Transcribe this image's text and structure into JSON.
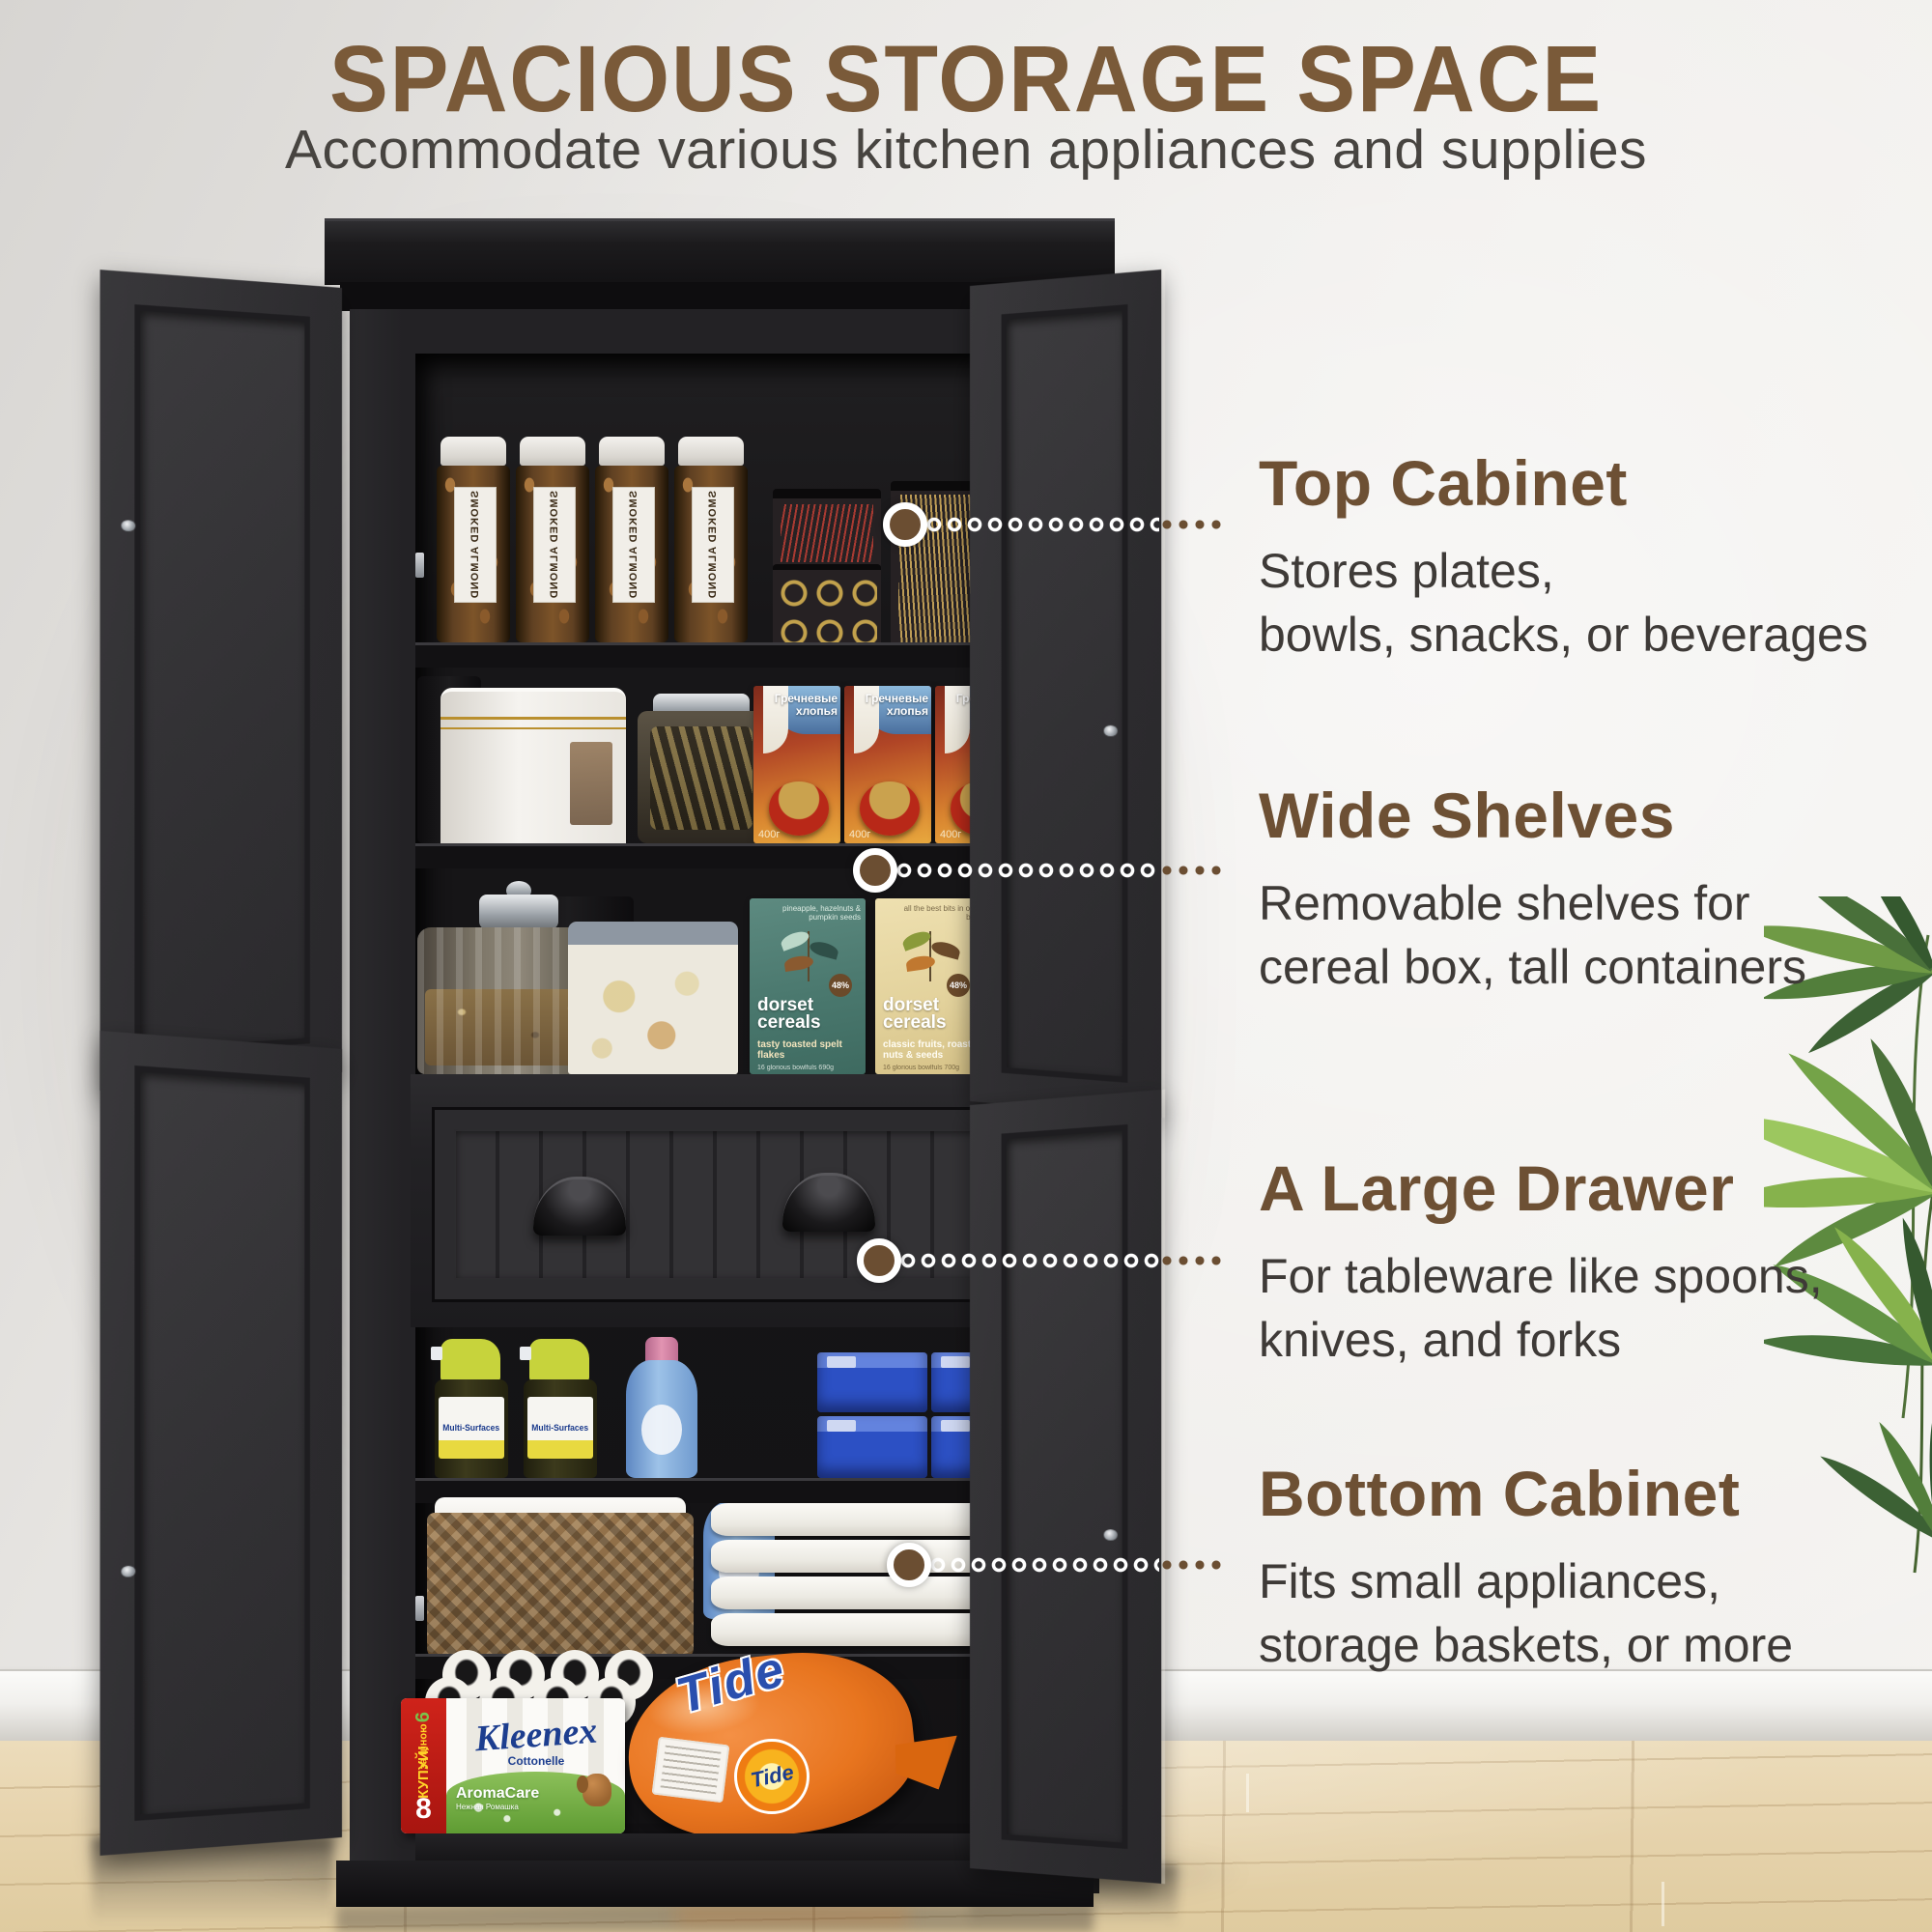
{
  "header": {
    "title": "SPACIOUS STORAGE SPACE",
    "subtitle": "Accommodate various kitchen appliances and supplies",
    "dot_colors": [
      "#f2dfcc",
      "#eeba6e",
      "#5f4936"
    ]
  },
  "callouts": [
    {
      "title": "Top Cabinet",
      "line1": "Stores plates,",
      "line2": "bowls, snacks, or beverages"
    },
    {
      "title": "Wide Shelves",
      "line1": "Removable shelves for",
      "line2": "cereal box, tall containers"
    },
    {
      "title": "A Large Drawer",
      "line1": "For tableware like spoons,",
      "line2": "knives, and forks"
    },
    {
      "title": "Bottom Cabinet",
      "line1": "Fits small appliances,",
      "line2": "storage baskets, or more"
    }
  ],
  "colors": {
    "accent_brown": "#6d5034",
    "title_brown": "#7a5a39",
    "body_text": "#3e3a37",
    "cabinet_black": "#1d1c1e",
    "wall": "#efedea",
    "floor_wood": "#e7d4ae"
  },
  "products": {
    "almond_label": "SMOKED ALMOND",
    "cereal_title": "Гречневые хлопья",
    "cereal_weight": "400г",
    "dorset_brand": "dorset cereals",
    "dorset_teal_note": "pineapple, hazelnuts & pumpkin seeds",
    "dorset_teal_variant": "tasty toasted spelt flakes",
    "dorset_teal_footer": "16 glorious bowlfuls 690g",
    "dorset_cream_note": "all the best bits in one box",
    "dorset_cream_variant": "classic fruits, roasted nuts & seeds",
    "dorset_cream_footer": "16 glorious bowlfuls 700g",
    "dorset_badge": "48%",
    "spray_label": "Multi-Surfaces",
    "kleenex_promo": "КУПУЙ!",
    "kleenex_promo_sub": "за ціною",
    "kleenex_promo_6": "6",
    "kleenex_promo_8": "8",
    "kleenex_brand": "Kleenex",
    "kleenex_sub": "Cottonelle",
    "kleenex_variant": "AromaCare",
    "kleenex_variant_sub": "Нежная Ромашка",
    "tide_brand": "Tide"
  }
}
